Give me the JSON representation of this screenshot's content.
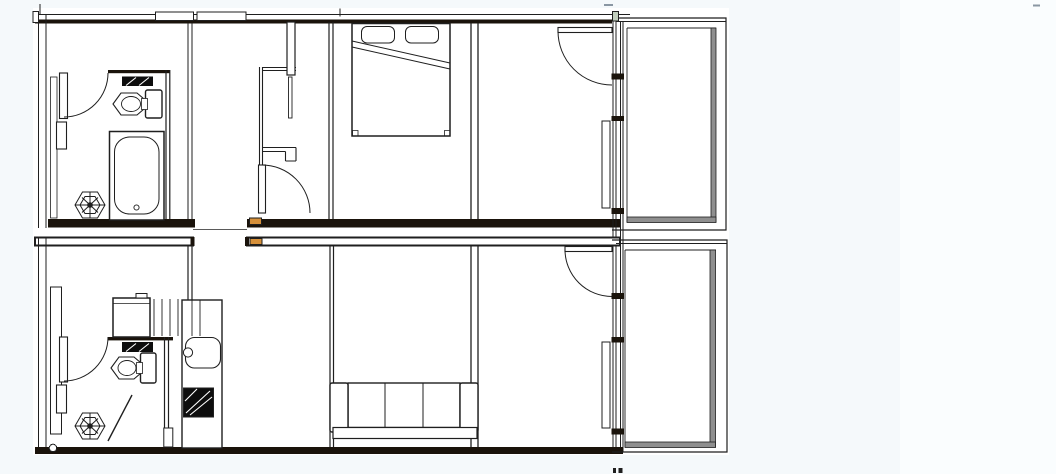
{
  "page": {
    "title": "Architectural floor plan — two stacked residential units with balconies",
    "background": "#f5f9fb",
    "background_right": "#fafdfe",
    "paper": "#ffffff"
  },
  "palette": {
    "line": "#1f1f1f",
    "line_soft": "#5a5a5a",
    "wall_fill": "#1a130b",
    "threshold": "#d6903a",
    "railing": "#8f8f8f",
    "stove": "#0d0d0d",
    "frame_green": "#c2cfbd",
    "artifact": "#8a97a3"
  },
  "plan": {
    "units": [
      {
        "name": "upper-unit",
        "rooms": [
          "bathroom",
          "entry-hall",
          "bedroom",
          "living-room",
          "balcony"
        ],
        "fixtures": [
          "vanity-counter",
          "toilet",
          "bathtub",
          "floor-drain",
          "bathroom-swing-door",
          "wardrobe-niche",
          "sliding-panel",
          "hall-swing-door",
          "double-bed",
          "two-pillows",
          "entry-swing-door",
          "side-windows",
          "balcony-railing"
        ]
      },
      {
        "name": "lower-unit",
        "rooms": [
          "bathroom",
          "kitchen",
          "entry-hall",
          "living-room",
          "balcony"
        ],
        "fixtures": [
          "vanity-counter",
          "toilet",
          "floor-drain",
          "chamfered-partition",
          "bathroom-swing-door",
          "washer-box",
          "louver-shaft",
          "kitchen-counter",
          "kitchen-sink",
          "cooktop",
          "three-seat-sofa",
          "entry-swing-door",
          "side-windows",
          "balcony-railing"
        ]
      }
    ]
  }
}
